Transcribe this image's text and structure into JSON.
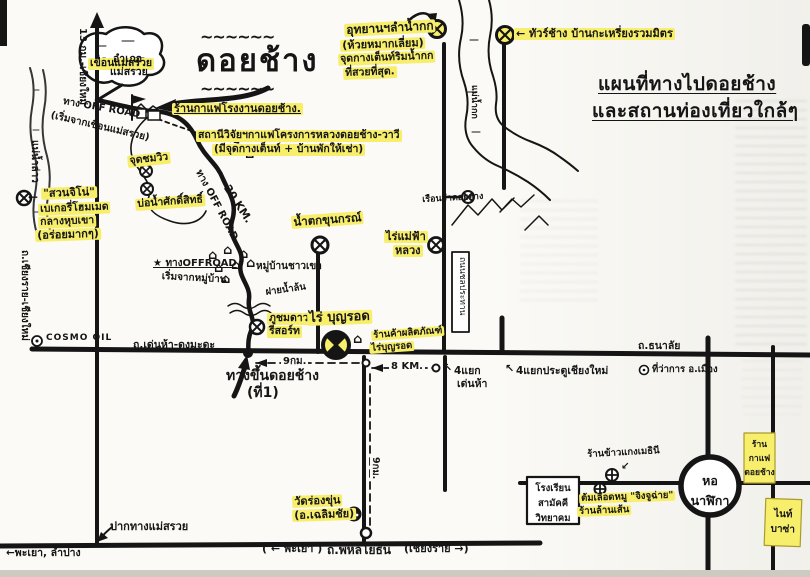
{
  "colors": {
    "highlight": "#f7ee6b",
    "ink": "#151515",
    "paper": "#fbfaf6"
  },
  "arrows": {
    "left": "←",
    "up_left": "↖",
    "down_left": "↙"
  },
  "icons": {
    "attraction_marker": "circle-x",
    "poi_marker": "circle-plus",
    "gas_marker": "circle-dot",
    "house": "⌂",
    "flag": "flag",
    "star": "★"
  },
  "labels": {
    "map_title": [
      "แผนที่ทางไปดอยช้าง",
      "และสถานท่องเที่ยวใกล้ๆ"
    ],
    "doi_chang_big": "ดอยช้าง",
    "squiggle": "~~~~~~",
    "kok_park": [
      "อุทยานฯลำน้ำกก",
      "(ห้วยหมากเลี่ยม)",
      "จุดกางเต็นท์ริมน้ำกก",
      "ที่สวยที่สุด."
    ],
    "elephant_tour": "← ทัวร์ช้าง บ้านกะเหรี่ยงรวมมิตร",
    "mae_nam_kok": "แม่น้ำกก",
    "coffee_factory": "ร้านกาแฟโรงงานดอยช้าง.",
    "research_station": [
      "สถานีวิจัยฯกาแฟโครงการหลวงดอยช้าง-วาวี",
      "(มีจุดกางเต็นท์ + บ้านพักให้เช่า)"
    ],
    "offroad_from_dam": [
      "ทาง OFF ROAD",
      "(เริ่มจากเขื่อนแม่สรวย)"
    ],
    "mae_suai_dam": "เขื่อนแม่สรวย",
    "amphoe_mae_suai": [
      "อำเภอ",
      "แม่สรวย"
    ],
    "to_chiang_mai": "13 กม.-เชียงใหม่",
    "mae_nam_lao": "แม่น้ำลาว",
    "jino_bakery": [
      "\"สวนจิโน่\"",
      "เบเกอรี่โฮมเมด",
      "กลางหุบเขา",
      "(อร่อยมากๆ)"
    ],
    "road_118": "ถ.เชียงราย-เชียงใหม่",
    "viewpoint": "จุดชมวิว",
    "sacred_well": "บ่อน้ำศักดิ์สิทธิ์",
    "km20": "20 KM.",
    "offroad_along": "ทาง OFF ROAD",
    "offroad_start": [
      "★ ทางOFFROAD",
      "เริ่มจากหมู่บ้าน"
    ],
    "hilltribe_village": "หมู่บ้านชาวเขา",
    "weir": "ฝายน้ำล้น",
    "phu_chom_dao": [
      "ภูชมดาว",
      "รีสอร์ท"
    ],
    "khun_korn_falls": "น้ำตกขุนกรณ์",
    "mae_fah_luang": [
      "ไร่แม่ฟ้า",
      "หลวง"
    ],
    "doi_hang_prison": "เรือนจำดอยฮาง",
    "chonprathan_road": "ถนนชลประทาน",
    "cosmo_oil": "COSMO OIL",
    "denha_dongmada_road": "ถ.เด่นห้า-ดงมะดะ",
    "boon_rawd_farm": "ไร่ บุญรอด",
    "boon_rawd_shop": [
      "ร้านค้าผลิตภัณฑ์",
      "ไร่บุญรอด"
    ],
    "km9_h": "9กม.",
    "km8": "8 KM.",
    "denha_junction": [
      "4แยก",
      "เด่นห้า"
    ],
    "cm_gate_junction": "4แยกประตูเชียงใหม่",
    "thanalai_road": "ถ.ธนาลัย",
    "muang_district_office": "ที่ว่าการ อ.เมือง",
    "way_up_doi_chang": [
      "ทางขึ้นดอยช้าง",
      "(ที่1)"
    ],
    "wat_rong_khun": [
      "วัดร่องขุ่น",
      "(อ.เฉลิมชัย)"
    ],
    "km9_v": "9กม.",
    "phayao_paren": "( ← พะเยา )",
    "phahonyothin_road": "ถ.พหลโยธิน",
    "chiangrai_paren": "(เชียงราย →)",
    "pak_thang_mae_suai": "ปากทางแม่สรวย",
    "phayao_lampang": "←พะเยา, ลำปาง",
    "samakkhi_school": [
      "โรงเรียน",
      "สามัคคี",
      "วิทยาคม"
    ],
    "clock_tower": [
      "หอ",
      "นาฬิกา"
    ],
    "rice_curry_shop": "ร้านข้าวแกงเมธินี",
    "blood_soup_shop": [
      "ต้มเลือดหมู \"จิงจูฉ่าย\"",
      "ร้านล้านเส้น"
    ],
    "doi_chang_cafe": [
      "ร้าน",
      "กาแฟ",
      "ดอยช้าง"
    ],
    "night_bazaar": [
      "ไนท์",
      "บาซ่า"
    ]
  }
}
